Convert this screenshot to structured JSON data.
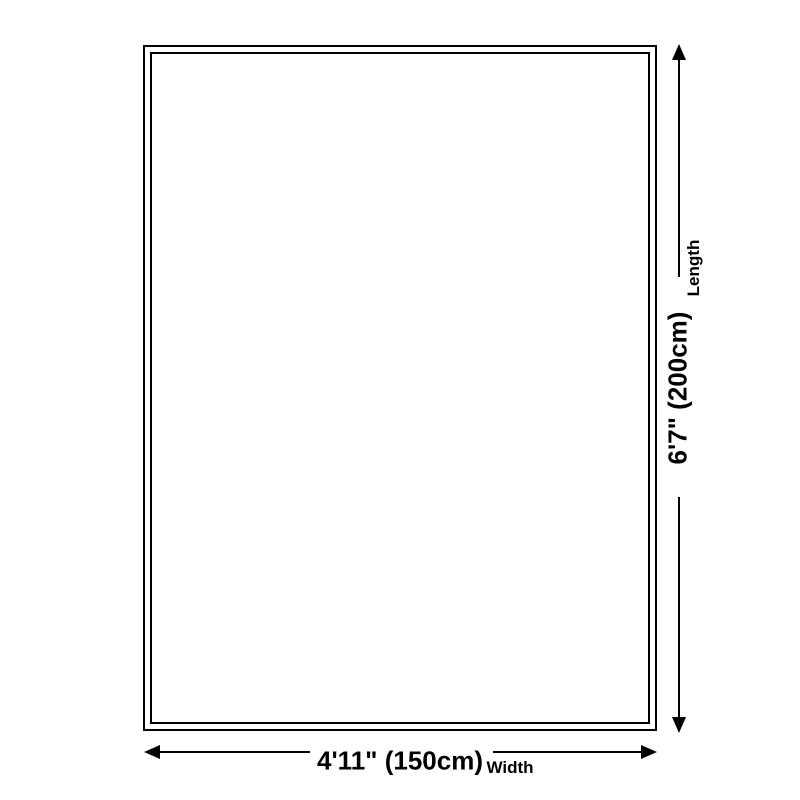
{
  "diagram": {
    "background_color": "#ffffff",
    "line_color": "#000000",
    "length_dimension": {
      "value": "6'7\" (200cm)",
      "label": "Length"
    },
    "width_dimension": {
      "value": "4'11\" (150cm)",
      "label": "Width"
    }
  }
}
